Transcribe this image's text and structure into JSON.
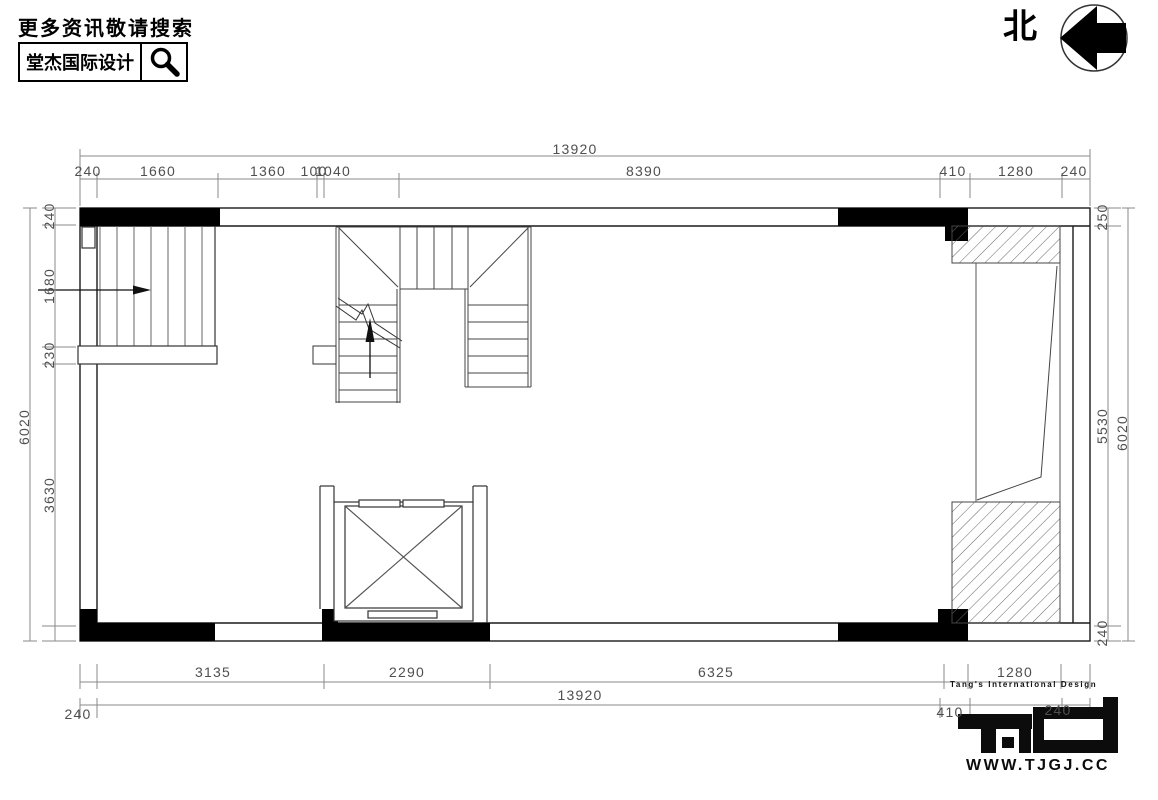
{
  "header": {
    "tagline": "更多资讯敬请搜索",
    "brand": "堂杰国际设计",
    "search_icon": "magnifier"
  },
  "compass": {
    "north_label": "北",
    "arrow_direction": "left"
  },
  "dimensions": {
    "top": {
      "overall": "13920",
      "chain": [
        "240",
        "1660",
        "1360",
        "100",
        "1040",
        "8390",
        "410",
        "1280",
        "240"
      ]
    },
    "bottom": {
      "overall": "13920",
      "chain": [
        "3135",
        "2290",
        "6325",
        "1280"
      ],
      "outer": [
        "240",
        "410",
        "240"
      ]
    },
    "left": {
      "overall": "6020",
      "chain": [
        "240",
        "1680",
        "230",
        "3630"
      ]
    },
    "right": {
      "overall": "6020",
      "chain": [
        "250",
        "5530",
        "240"
      ]
    }
  },
  "logo": {
    "subtitle": "Tang's International Design",
    "monogram": "T·ID",
    "url": "WWW.TJGJ.CC"
  },
  "colors": {
    "ink": "#000000",
    "wall_line": "#1a1a1a",
    "dim_line": "#8a8a8a",
    "dim_text": "#4f4f4f",
    "background": "#ffffff"
  }
}
